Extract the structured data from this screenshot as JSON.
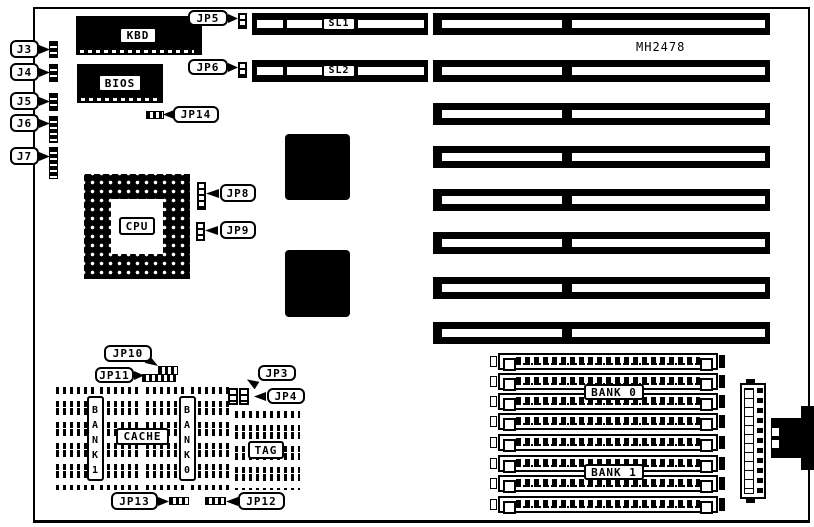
{
  "board": {
    "model_number": "MH2478"
  },
  "left_connectors": {
    "j3": "J3",
    "j4": "J4",
    "j5": "J5",
    "j6": "J6",
    "j7": "J7"
  },
  "chips": {
    "keyboard": "KBD",
    "bios": "BIOS",
    "cpu": "CPU"
  },
  "jumpers": {
    "jp3": "JP3",
    "jp4": "JP4",
    "jp5": "JP5",
    "jp6": "JP6",
    "jp8": "JP8",
    "jp9": "JP9",
    "jp10": "JP10",
    "jp11": "JP11",
    "jp12": "JP12",
    "jp13": "JP13",
    "jp14": "JP14"
  },
  "slots": {
    "sl1": "SL1",
    "sl2": "SL2"
  },
  "cache": {
    "bank1": "B\nA\nN\nK\n1",
    "bank0": "B\nA\nN\nK\n0",
    "cache": "CACHE",
    "tag": "TAG"
  },
  "memory": {
    "bank0": "BANK 0",
    "bank1": "BANK 1"
  }
}
